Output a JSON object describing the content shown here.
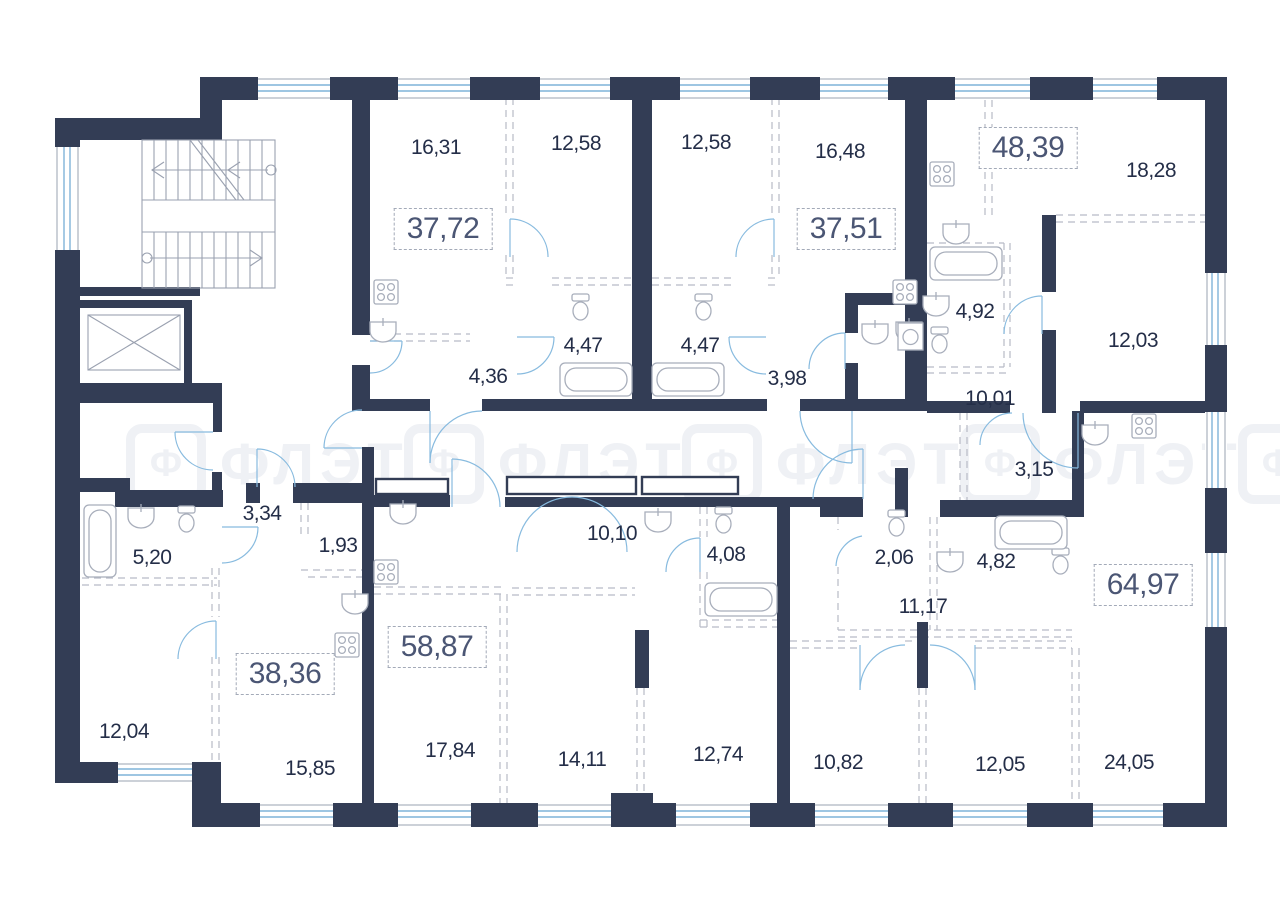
{
  "watermark": {
    "logo_letter": "Ф",
    "text": "ФЛЭТ"
  },
  "apartments": [
    {
      "total": "37,72"
    },
    {
      "total": "37,51"
    },
    {
      "total": "48,39"
    },
    {
      "total": "38,36"
    },
    {
      "total": "58,87"
    },
    {
      "total": "64,97"
    }
  ],
  "rooms": [
    {
      "area": "16,31"
    },
    {
      "area": "12,58"
    },
    {
      "area": "12,58"
    },
    {
      "area": "16,48"
    },
    {
      "area": "18,28"
    },
    {
      "area": "4,47"
    },
    {
      "area": "4,47"
    },
    {
      "area": "4,36"
    },
    {
      "area": "3,98"
    },
    {
      "area": "4,92"
    },
    {
      "area": "12,03"
    },
    {
      "area": "10,01"
    },
    {
      "area": "3,15"
    },
    {
      "area": "3,34"
    },
    {
      "area": "1,93"
    },
    {
      "area": "5,20"
    },
    {
      "area": "10,10"
    },
    {
      "area": "4,08"
    },
    {
      "area": "2,06"
    },
    {
      "area": "4,82"
    },
    {
      "area": "11,17"
    },
    {
      "area": "12,04"
    },
    {
      "area": "15,85"
    },
    {
      "area": "17,84"
    },
    {
      "area": "14,11"
    },
    {
      "area": "12,74"
    },
    {
      "area": "10,82"
    },
    {
      "area": "12,05"
    },
    {
      "area": "24,05"
    }
  ],
  "colors": {
    "wall": "#333d55",
    "window": "#7fb4d9",
    "door_arc": "#88bbdf",
    "fixture_outline": "#a8aebb",
    "dashed_partition": "#b7bbc6",
    "room_label": "#242e48",
    "apartment_label": "#4b5674",
    "watermark": "#eff1f5"
  }
}
